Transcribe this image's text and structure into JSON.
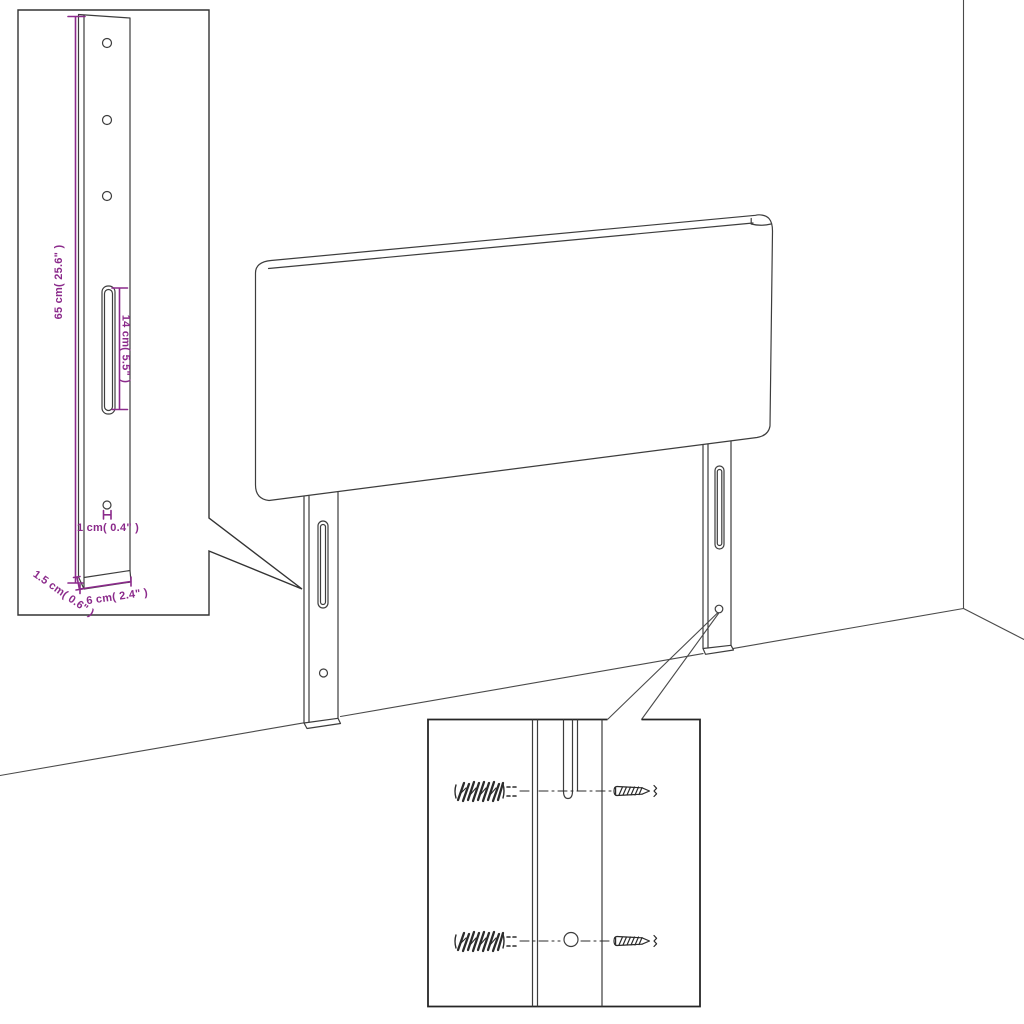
{
  "diagram": {
    "subject": "headboard-wall-mount-assembly",
    "colors": {
      "background": "#ffffff",
      "outline": "#3d3d3d",
      "dimension_accent": "#8b2a8b"
    },
    "leg_detail_inset": {
      "labels": {
        "height": "65 cm( 25.6\" )",
        "slot_length": "14 cm( 5.5\" )",
        "hole_diameter": "1 cm( 0.4\" )",
        "depth": "1.5 cm( 0.6\" )",
        "width": "6 cm( 2.4\" )"
      },
      "hole_count": 3
    },
    "headboard": {
      "leg_count": 2
    },
    "hardware_inset": {
      "wall_plug_count": 2,
      "screw_count": 2
    }
  }
}
